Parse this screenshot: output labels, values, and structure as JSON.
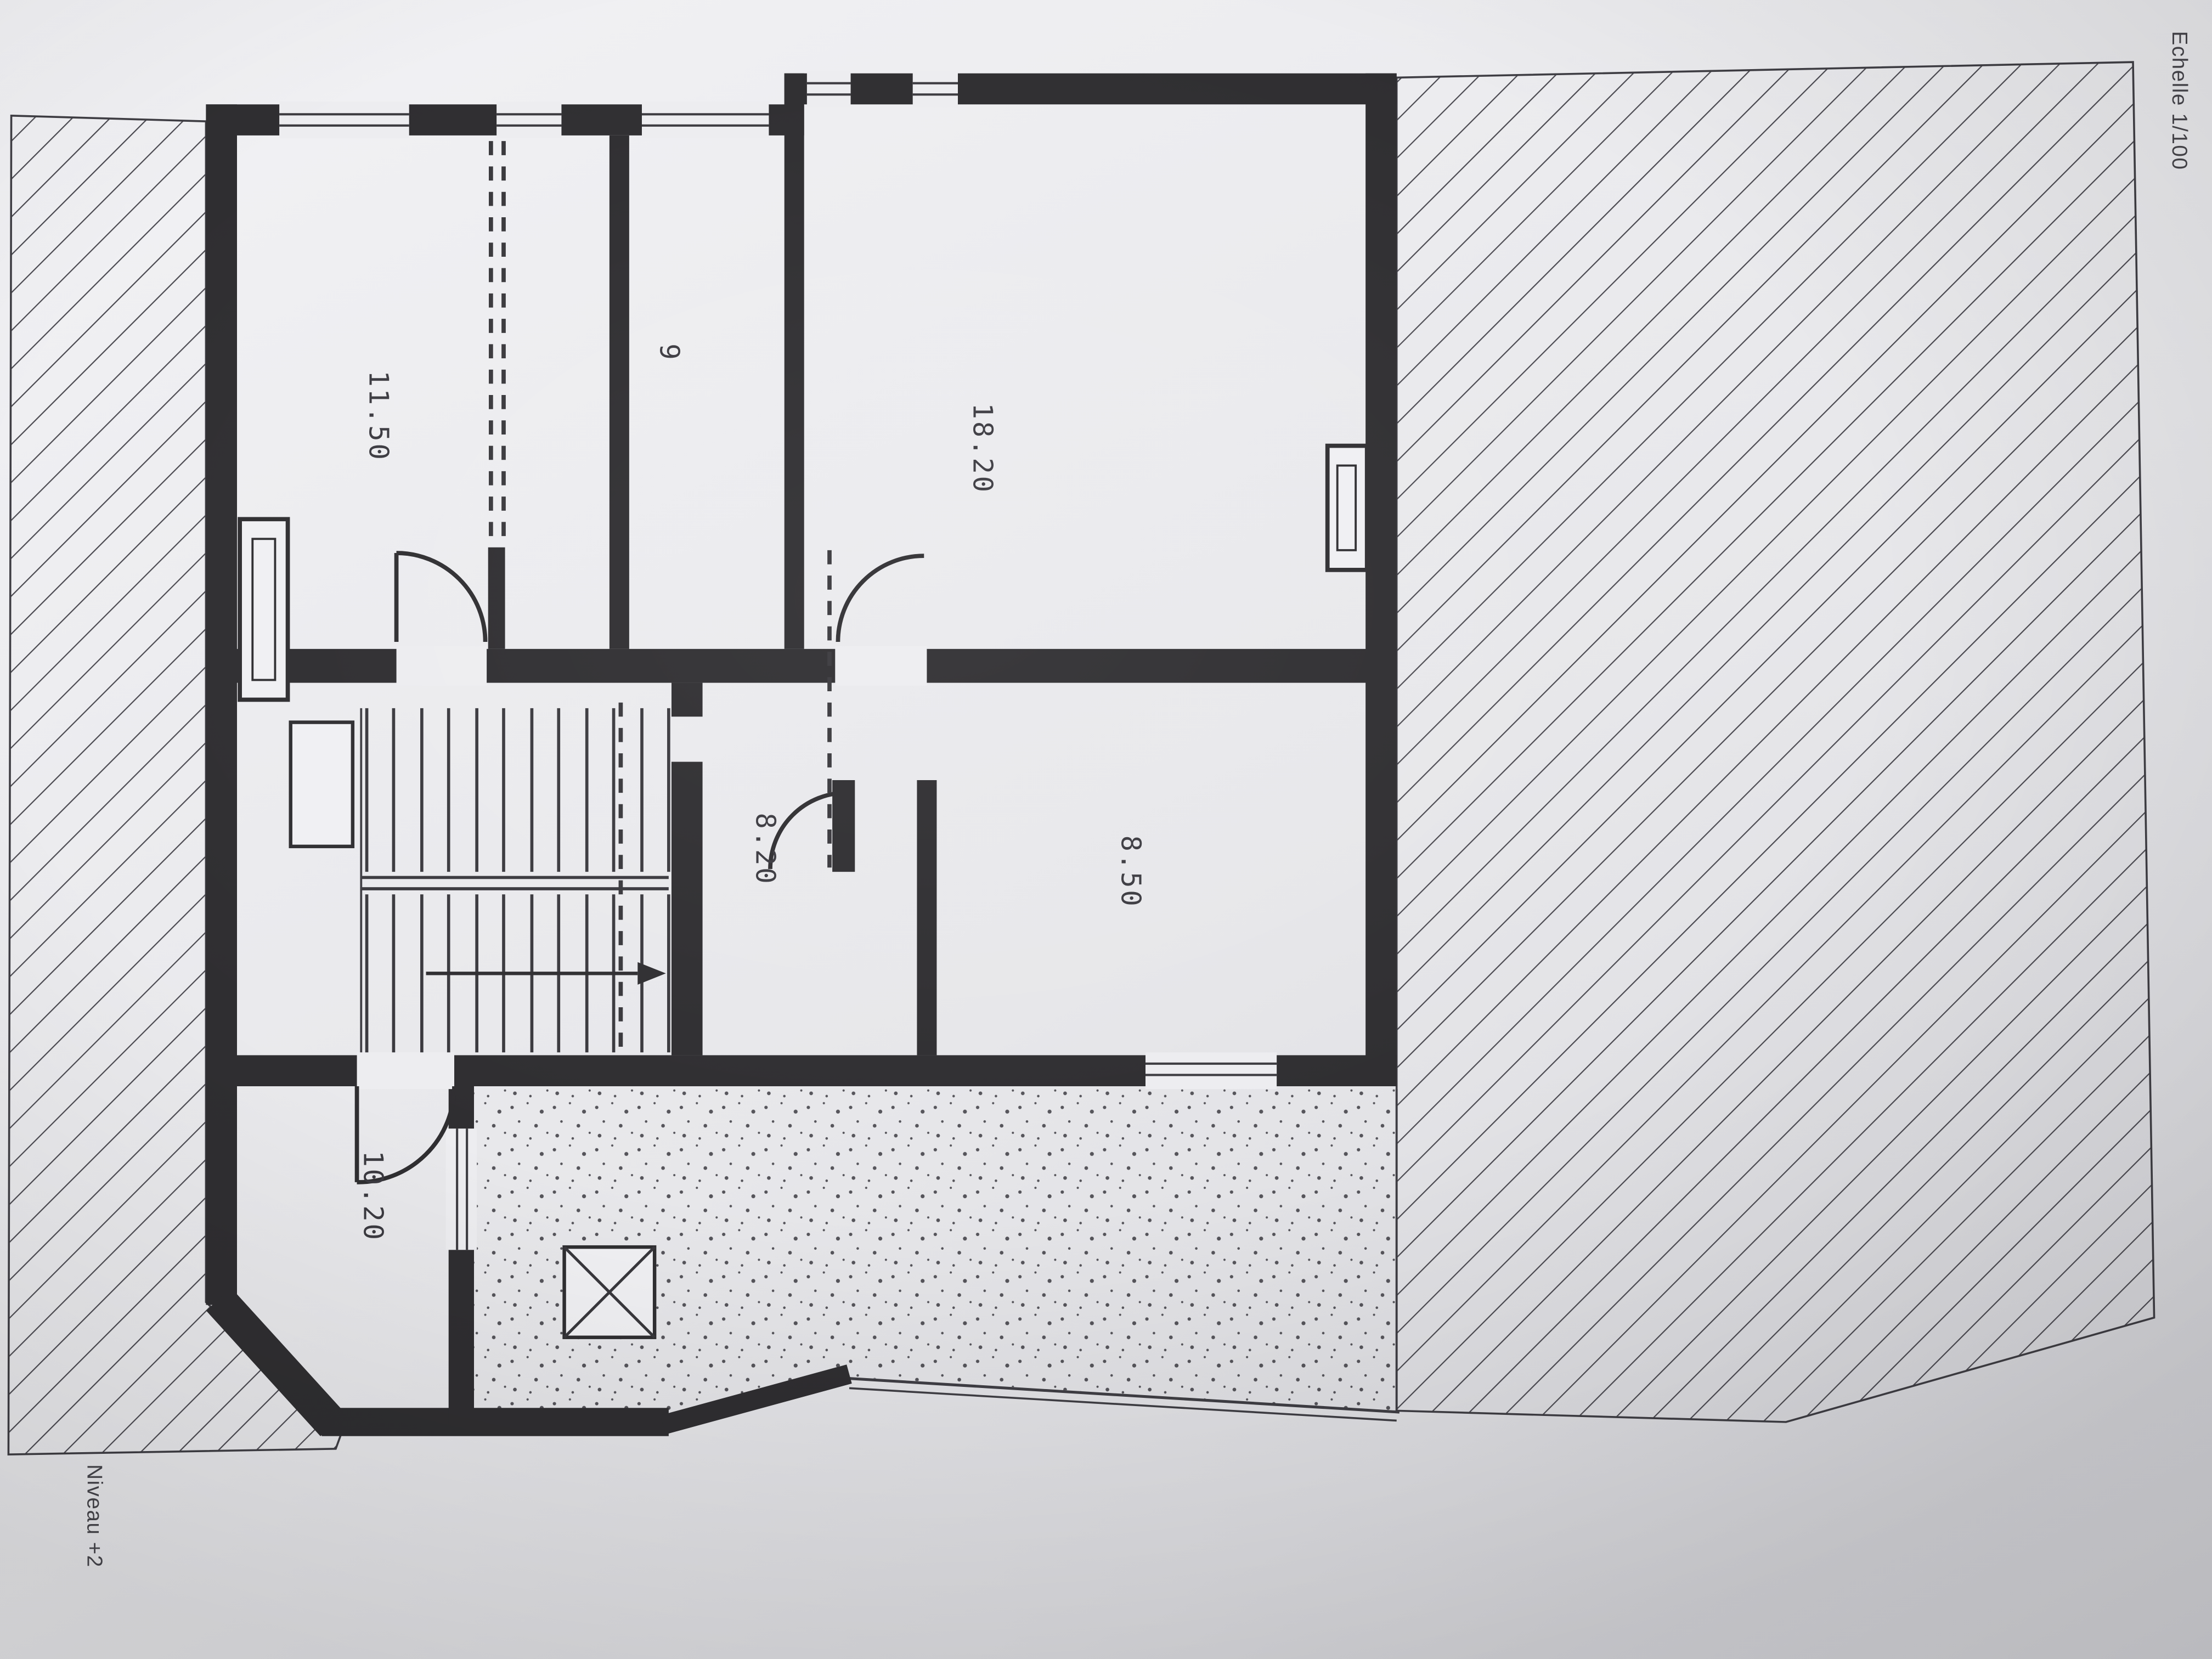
{
  "plan": {
    "level_label": "Niveau +2",
    "scale_label": "Echelle 1/100",
    "rooms": [
      {
        "name": "bedroom-top-left",
        "area": "11.50"
      },
      {
        "name": "room-top-center",
        "area": "9"
      },
      {
        "name": "bedroom-top-right",
        "area": "18.20"
      },
      {
        "name": "hall",
        "area": "8.20"
      },
      {
        "name": "room-mid-right",
        "area": "8.50"
      },
      {
        "name": "room-bottom-left",
        "area": "10.20"
      }
    ],
    "symbols": [
      "roof-hatch",
      "terrace-stipple",
      "skylight-x-box",
      "stairs-with-arrow",
      "door-arc",
      "window-double-line",
      "radiator"
    ],
    "colors": {
      "paper": "#ebebee",
      "ink": "#2f2e31",
      "hatch_line": "#4a4950",
      "stipple_dot": "#55545a"
    }
  }
}
